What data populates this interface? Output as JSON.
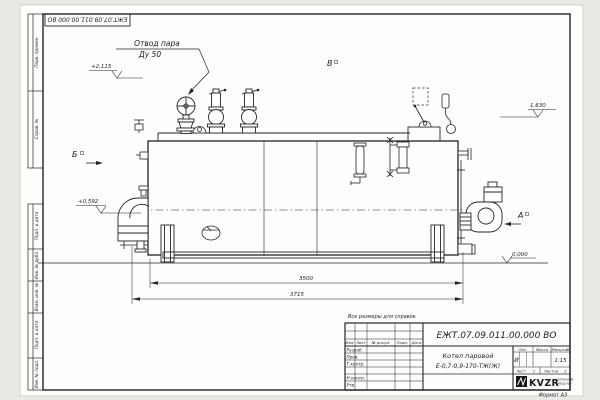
{
  "corner_stamp": "ЕЖТ.07.09.011.00.000 ВО",
  "margin": [
    "Перв. примен.",
    "Справ. №",
    "Подп. и дата",
    "Инв. № дубл.",
    "Взам. инв. №",
    "Подп. и дата",
    "Инв. № подл."
  ],
  "callout": {
    "line1": "Отвод пара",
    "line2": "Ду 50"
  },
  "views": {
    "b": "Б",
    "v": "В",
    "a": "А"
  },
  "elevations": {
    "top": "+2,115",
    "right": "1,630",
    "left": "+0,592",
    "ground": "0,000"
  },
  "dims": {
    "inner": "3500",
    "outer": "3715"
  },
  "note": "Все размеры для справок",
  "titleblock": {
    "number": "ЕЖТ.07.09.011.00.000  ВО",
    "name1": "Котел паровой",
    "name2": "Е-0,7-0,9-170-ТЖ(Ж)",
    "col_izm": "Изм.",
    "col_list": "Лист",
    "col_doc": "№ докум.",
    "col_podp": "Подп.",
    "col_data": "Дата",
    "row_razrab": "Разраб.",
    "row_prov": "Пров.",
    "row_tkontr": "Т.контр.",
    "row_nkontr": "Н.контр.",
    "row_utv": "Утв.",
    "lit_label": "Лит.",
    "mass_label": "Масса",
    "scale_label": "Масштаб",
    "lit": "И",
    "scale": "1:15",
    "sheet_label": "Лист",
    "sheet": "1",
    "sheets_label": "Листов",
    "sheets": "2",
    "format": "Формат А3"
  },
  "logo": {
    "name": "KVZR",
    "sub1": "КОТЕЛЬНЫЙ",
    "sub2": "ЗАВОД РЭП"
  }
}
